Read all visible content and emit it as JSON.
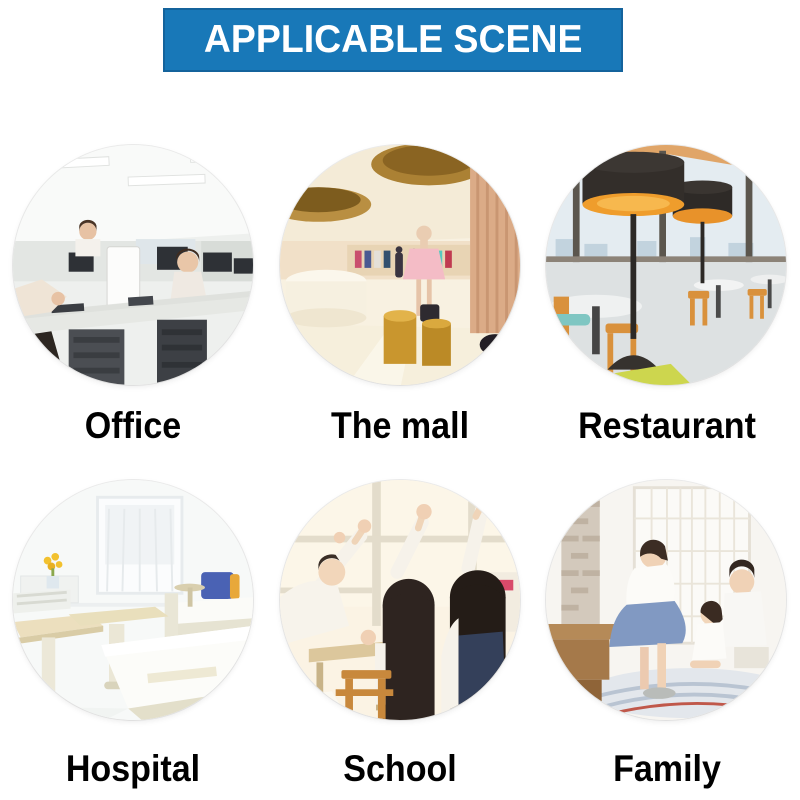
{
  "banner": {
    "label": "APPLICABLE SCENE"
  },
  "colors": {
    "banner_bg": "#1878b8",
    "banner_border": "#14639c",
    "banner_text": "#ffffff",
    "label_text": "#000000",
    "page_bg": "#ffffff"
  },
  "scenes": [
    {
      "label": "Office",
      "photo": "open-plan office with desks, monitors, white PC tower and workers"
    },
    {
      "label": "The mall",
      "photo": "luxury mall interior with gold ceiling rings, mannequin in pink dress and gold display pedestals"
    },
    {
      "label": "Restaurant",
      "photo": "modern restaurant with large black pendant lamps, city-view windows and orange chairs"
    },
    {
      "label": "Hospital",
      "photo": "bright white hospital ward with beds, overbed tables, window and yellow flowers"
    },
    {
      "label": "School",
      "photo": "classroom with students raising hands by a bright window, wooden desks and chairs"
    },
    {
      "label": "Family",
      "photo": "parents playing with child at home near white french doors on a striped rug"
    }
  ]
}
